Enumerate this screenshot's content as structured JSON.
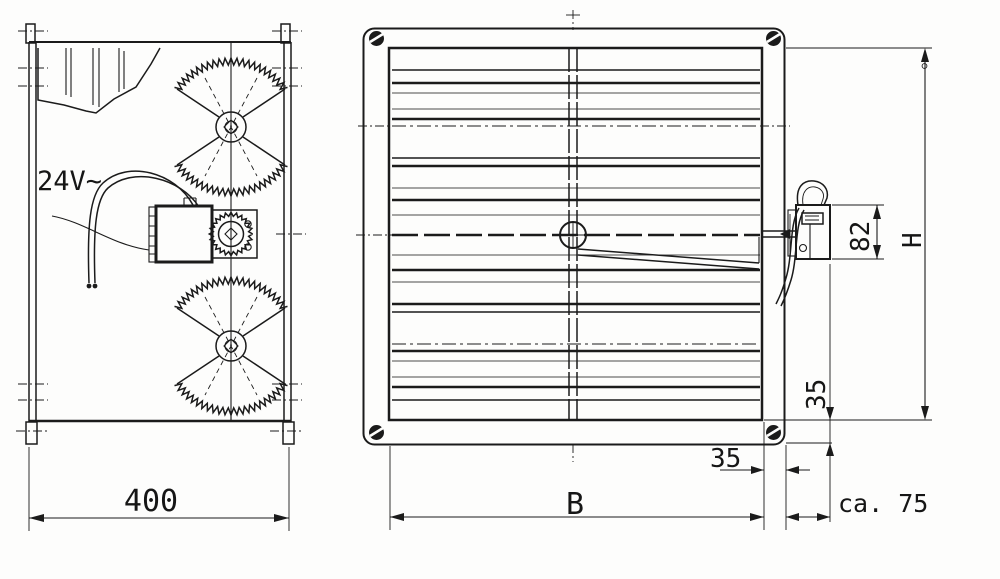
{
  "drawing": {
    "title": "louver damper with actuator - dimensioned drawing",
    "colors": {
      "ink": "#1b1b1b",
      "background": "#fdfdfc"
    },
    "side_view": {
      "voltage": "24V~",
      "depth": "400"
    },
    "front_view": {
      "width": "B",
      "height": "H",
      "motor_height": "82",
      "flange_offset": "35",
      "frame_profile": "35",
      "motor_projection": "ca. 75"
    }
  }
}
